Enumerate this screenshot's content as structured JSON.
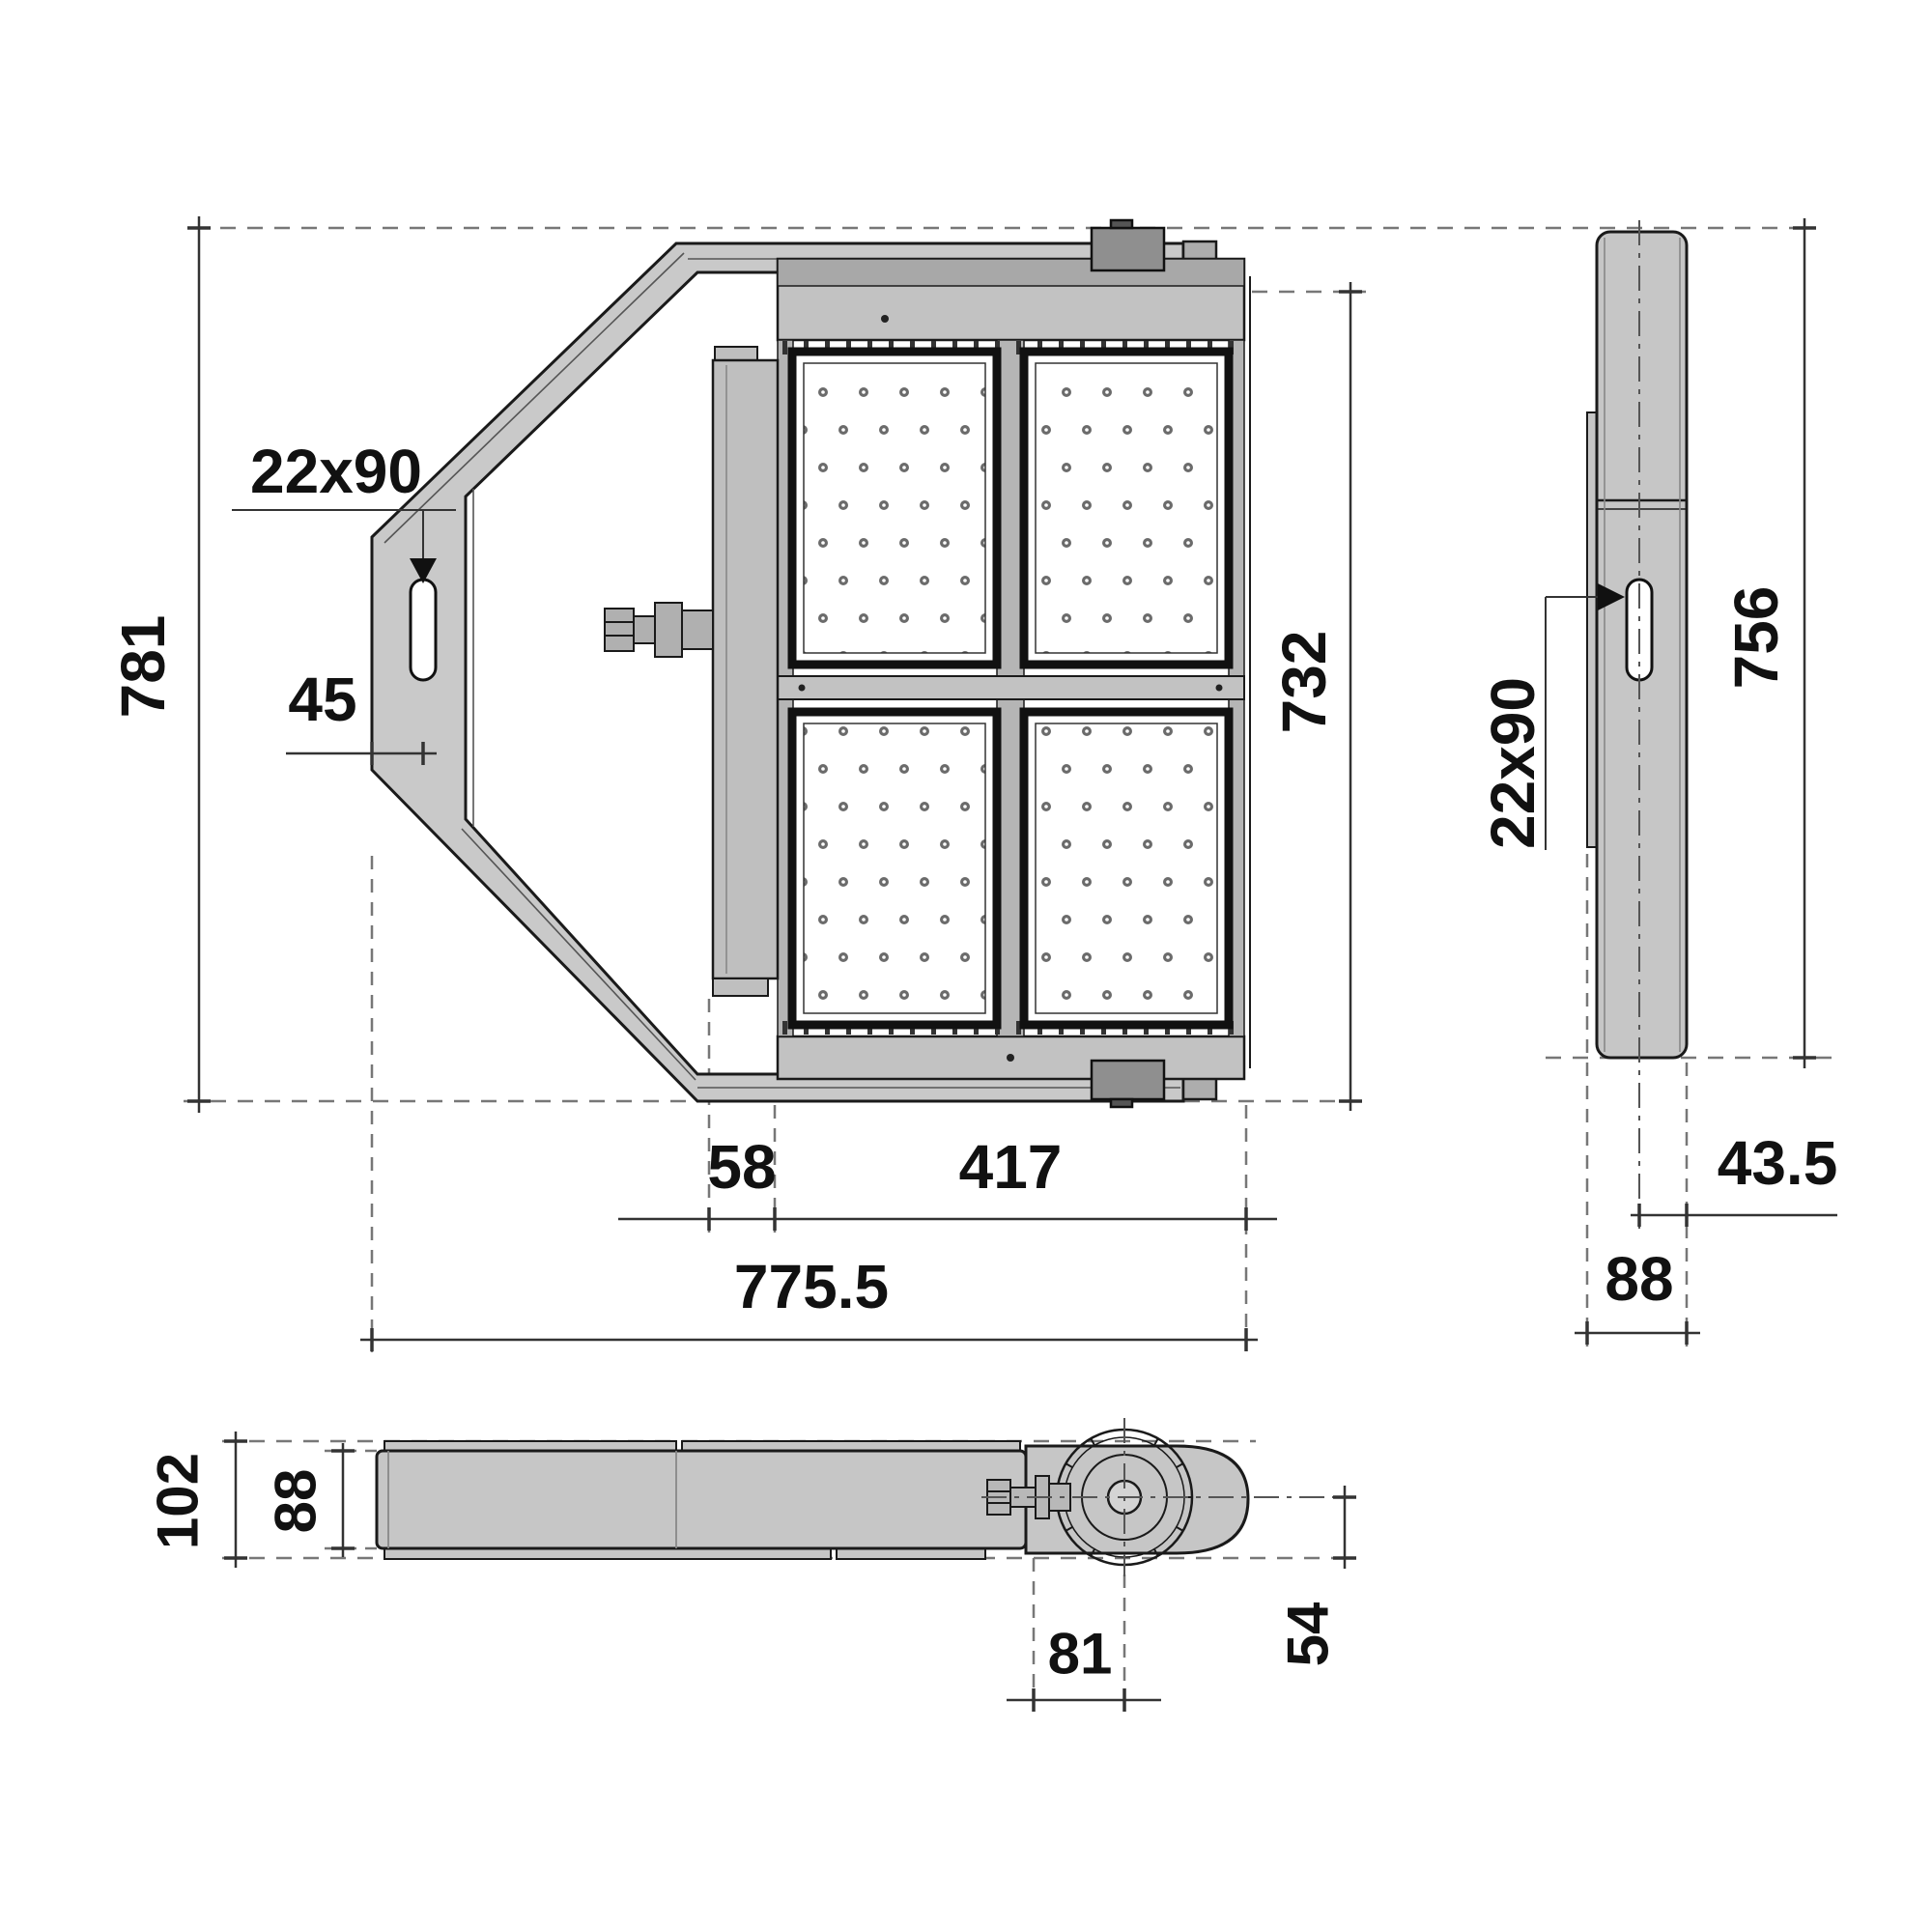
{
  "drawing": {
    "kind": "luminaire-dimension-drawing",
    "views": [
      "front-view",
      "side-view",
      "bottom-view"
    ]
  },
  "dims": {
    "front": {
      "overall_height": "781",
      "slot_size": "22x90",
      "slot_offset": "45",
      "led_housing_height": "732",
      "gland_offset": "58",
      "housing_width": "417",
      "overall_width": "775.5"
    },
    "side": {
      "slot_size": "22x90",
      "overall_height": "756",
      "rear_depth": "43.5",
      "overall_depth": "88"
    },
    "bottom": {
      "overall_depth": "102",
      "body_depth": "88",
      "axis_to_face": "54",
      "bolt_to_axis": "81"
    }
  },
  "colors": {
    "outline": "#1a1a1a",
    "body_fill": "#c6c6c6",
    "bracket_fill": "#c9c9c9",
    "mid_gray": "#b0b0b0",
    "dark_part": "#8f8f8f",
    "panel_fill": "#ffffff",
    "led_dot": "#6b6b6b",
    "dashed_line": "#777777",
    "dim_line": "#333333",
    "text": "#111111"
  }
}
